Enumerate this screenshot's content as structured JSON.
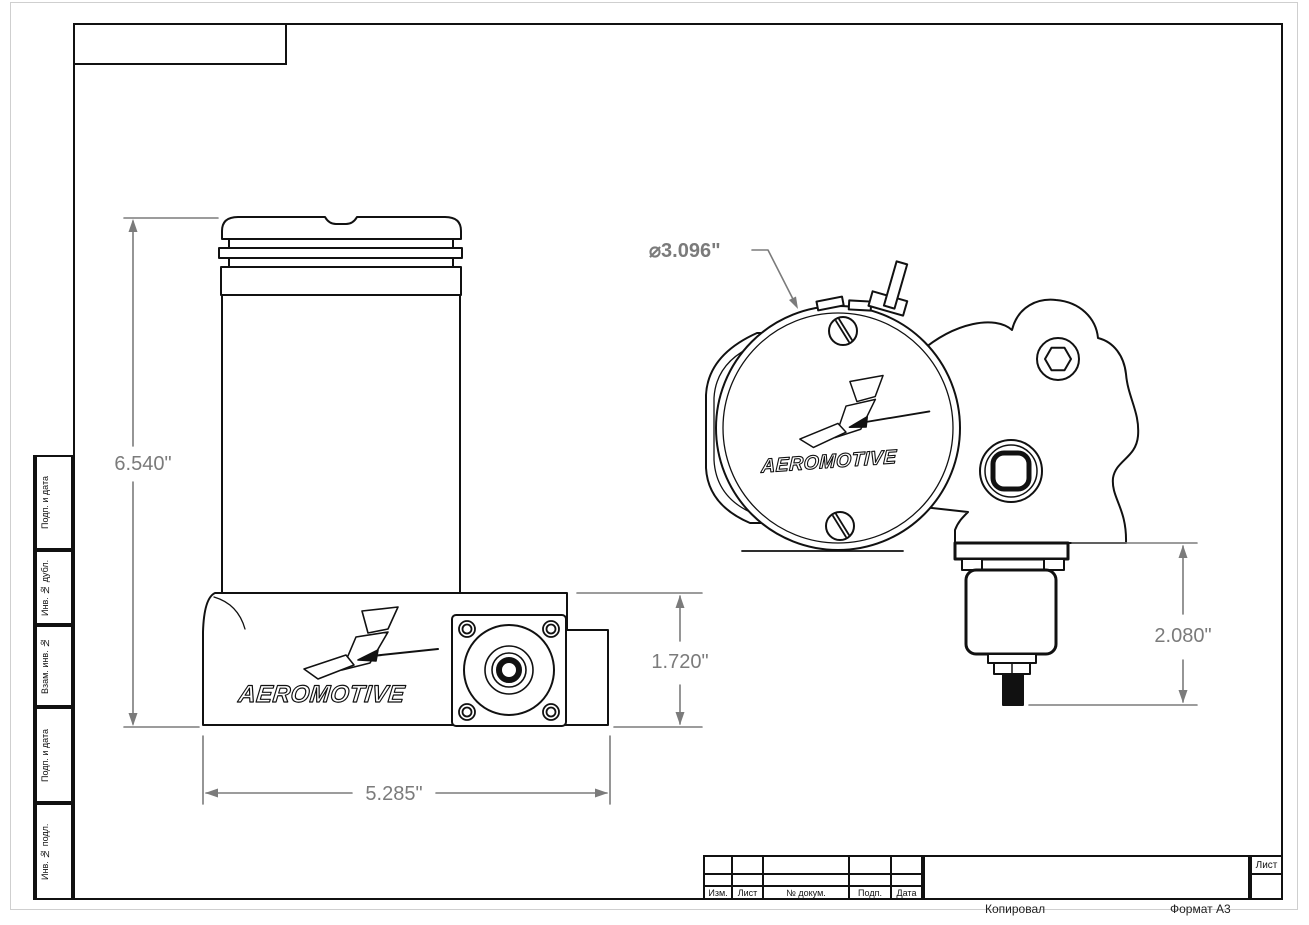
{
  "page": {
    "footer_copied": "Копировал",
    "footer_format": "Формат A3"
  },
  "frame": {
    "sidebar": {
      "labels": [
        "Подп. и дата",
        "Инв. № дубл.",
        "Взам. инв. №",
        "Подп. и дата",
        "Инв. № подл."
      ]
    },
    "title_block": {
      "col_izm": "Изм.",
      "col_list": "Лист",
      "col_doc": "№ докум.",
      "col_sign": "Подп.",
      "col_date": "Дата",
      "sheet_label": "Лист"
    }
  },
  "drawing": {
    "brand": "AEROMOTIVE",
    "dims": {
      "overall_height": "6.540\"",
      "base_width": "5.285\"",
      "base_height": "1.720\"",
      "valve_height": "2.080\"",
      "cap_diameter": "⌀3.096\""
    }
  },
  "colors": {
    "drawing_line": "#111111",
    "dimension_gray": "#7b7b7b"
  }
}
